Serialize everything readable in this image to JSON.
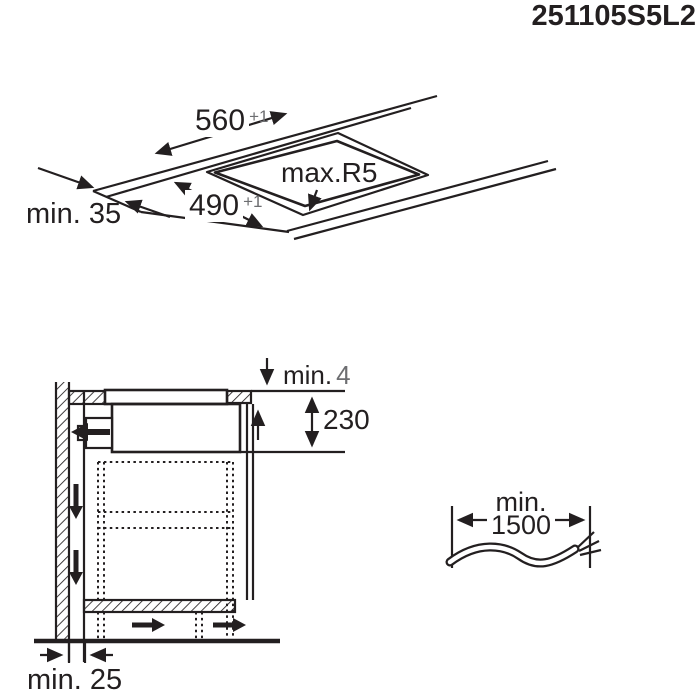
{
  "part_number": "251105S5L2",
  "worktop_view": {
    "width_dim": {
      "value": "560",
      "tolerance": "+1"
    },
    "depth_dim": {
      "value": "490",
      "tolerance": "+1"
    },
    "corner_radius": "max.R5",
    "front_clearance": "min. 35"
  },
  "cabinet_view": {
    "top_gap": {
      "label": "min.",
      "value": "4"
    },
    "hob_depth": "230",
    "wall_gap": "min. 25"
  },
  "cable": {
    "label": "min.",
    "length": "1500"
  },
  "colors": {
    "line": "#231f20",
    "tolerance_gray": "#6d6e71",
    "background": "#ffffff"
  }
}
